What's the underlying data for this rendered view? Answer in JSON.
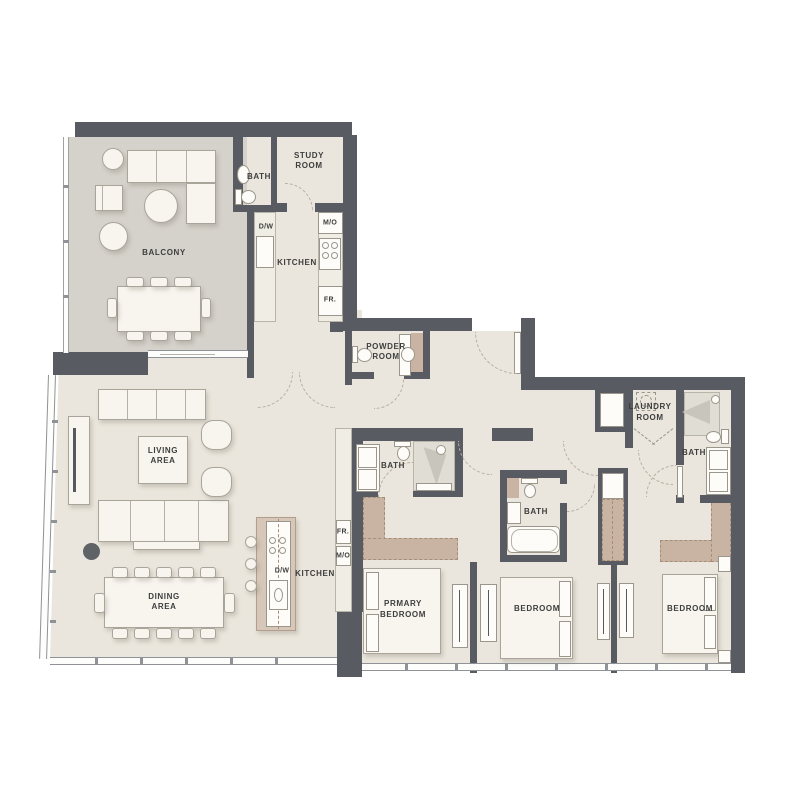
{
  "title": "Apartment Floor Plan",
  "colors": {
    "wall": "#585b61",
    "floor": "#eae6dd",
    "balcony_floor": "#d5d2cb",
    "closet_tan": "#c9b3a2",
    "island_tan": "#d6c7b8",
    "cabinet": "#f0ede5",
    "furniture": "#f7f5ee",
    "furniture_line": "#a9a59b",
    "fixture": "#fdfcf8",
    "shower_floor": "#e0ddd5",
    "window_line": "#8f9296",
    "label": "#3e3e3e",
    "arc": "#b6afa1"
  },
  "rooms": {
    "balcony": {
      "label": "BALCONY"
    },
    "bath_top": {
      "label": "BATH"
    },
    "study_room": {
      "label_line1": "STUDY",
      "label_line2": "ROOM"
    },
    "kitchen_top": {
      "label": "KITCHEN",
      "dw": "D/W",
      "mo": "M/O",
      "fr": "FR."
    },
    "powder_room": {
      "label_line1": "POWDER",
      "label_line2": "ROOM"
    },
    "living_area": {
      "label_line1": "LIVING",
      "label_line2": "AREA"
    },
    "dining_area": {
      "label_line1": "DINING",
      "label_line2": "AREA"
    },
    "kitchen_main": {
      "label": "KITCHEN",
      "dw": "D/W",
      "fr": "FR.",
      "mo": "M/O"
    },
    "primary_bath": {
      "label": "BATH"
    },
    "primary_bedroom": {
      "label_line1": "PRMARY",
      "label_line2": "BEDROOM"
    },
    "bath_2": {
      "label": "BATH"
    },
    "bedroom_2": {
      "label": "BEDROOM"
    },
    "bath_3": {
      "label": "BATH"
    },
    "bedroom_3": {
      "label": "BEDROOM"
    },
    "laundry_room": {
      "label_line1": "LAUNDRY",
      "label_line2": "ROOM"
    }
  }
}
